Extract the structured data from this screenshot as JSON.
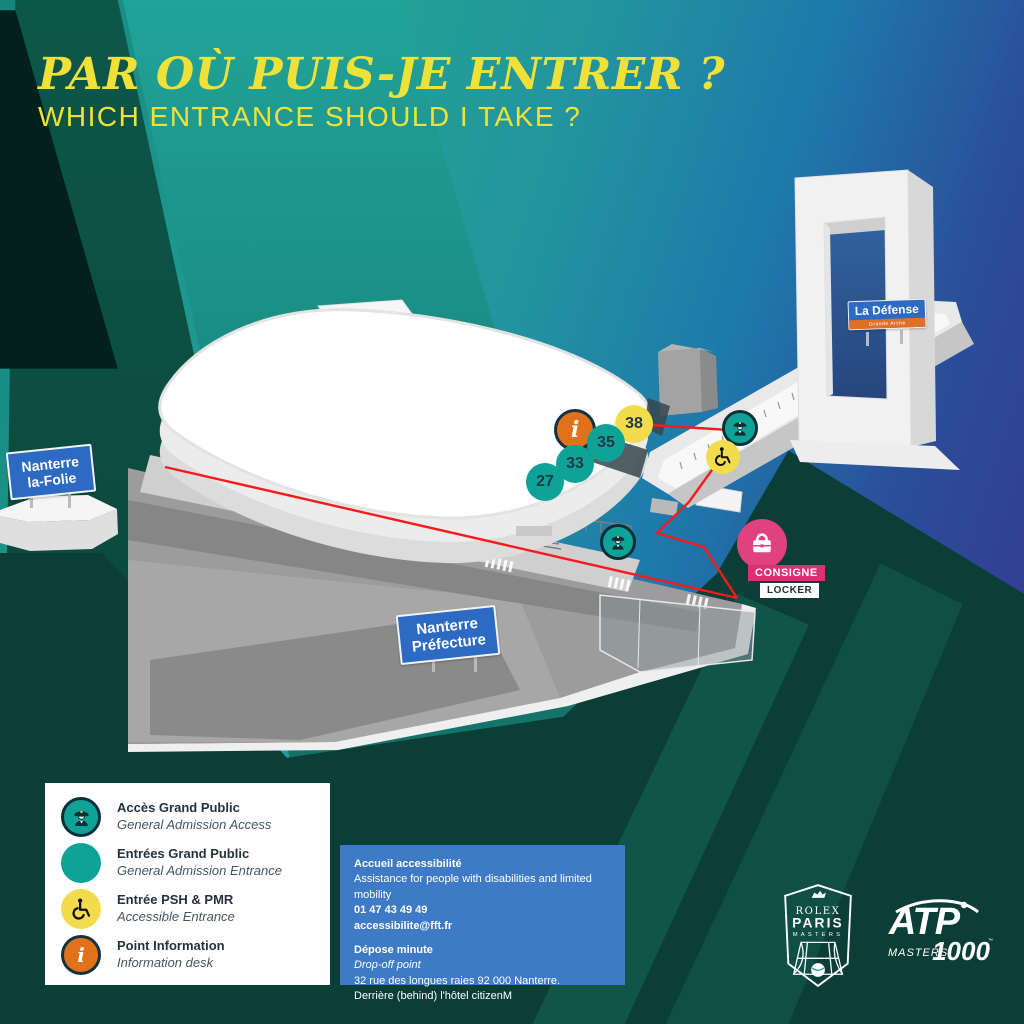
{
  "header": {
    "title_fr": "PAR OÙ PUIS-JE ENTRER ?",
    "title_en": "WHICH ENTRANCE SHOULD I TAKE ?"
  },
  "map": {
    "signs": {
      "la_folie_line1": "Nanterre",
      "la_folie_line2": "la-Folie",
      "prefecture_line1": "Nanterre",
      "prefecture_line2": "Préfecture",
      "la_defense_title": "La Défense",
      "la_defense_sub": "Grande Arche"
    },
    "entrances": {
      "e38": "38",
      "e35": "35",
      "e33": "33",
      "e27": "27"
    },
    "info_marker": "i",
    "locker": {
      "fr": "CONSIGNE",
      "en": "LOCKER"
    }
  },
  "legend": {
    "items": [
      {
        "icon": "guard-icon",
        "fr": "Accès Grand Public",
        "en": "General Admission Access"
      },
      {
        "icon": "entrance-dot",
        "fr": "Entrées Grand Public",
        "en": "General Admission Entrance"
      },
      {
        "icon": "wheelchair-icon",
        "fr": "Entrée PSH & PMR",
        "en": "Accessible Entrance"
      },
      {
        "icon": "info-icon",
        "fr": "Point Information",
        "en": "Information desk"
      }
    ]
  },
  "info_box": {
    "accessibility_title": "Accueil accessibilité",
    "accessibility_desc": "Assistance for people with disabilities and limited mobility",
    "phone": "01 47 43 49 49",
    "email": "accessibilite@fft.fr",
    "dropoff_title": "Dépose minute",
    "dropoff_sub": "Drop-off point",
    "dropoff_address": "32 rue des longues raies  92 000 Nanterre.",
    "dropoff_note": "Derrière (behind) l'hôtel citizenM"
  },
  "logos": {
    "rpm_line1": "ROLEX",
    "rpm_line2": "PARIS",
    "rpm_line3": "MASTERS",
    "atp_line1": "ATP",
    "atp_line2": "MASTERS",
    "atp_line3": "1000",
    "atp_tm": "™"
  },
  "colors": {
    "accent_yellow": "#F0E139",
    "teal_marker": "#0FA297",
    "yellow_marker": "#F2DC4E",
    "orange_marker": "#E2711B",
    "pink_marker": "#E0417F",
    "sign_blue": "#2D6AC3",
    "sign_orange": "#E07025",
    "info_box_blue": "#3E7AC6",
    "route_red": "#F61A1A",
    "bg_dark_green": "#0A3E36",
    "bg_teal": "#21A399",
    "bg_indigo": "#343B92"
  }
}
